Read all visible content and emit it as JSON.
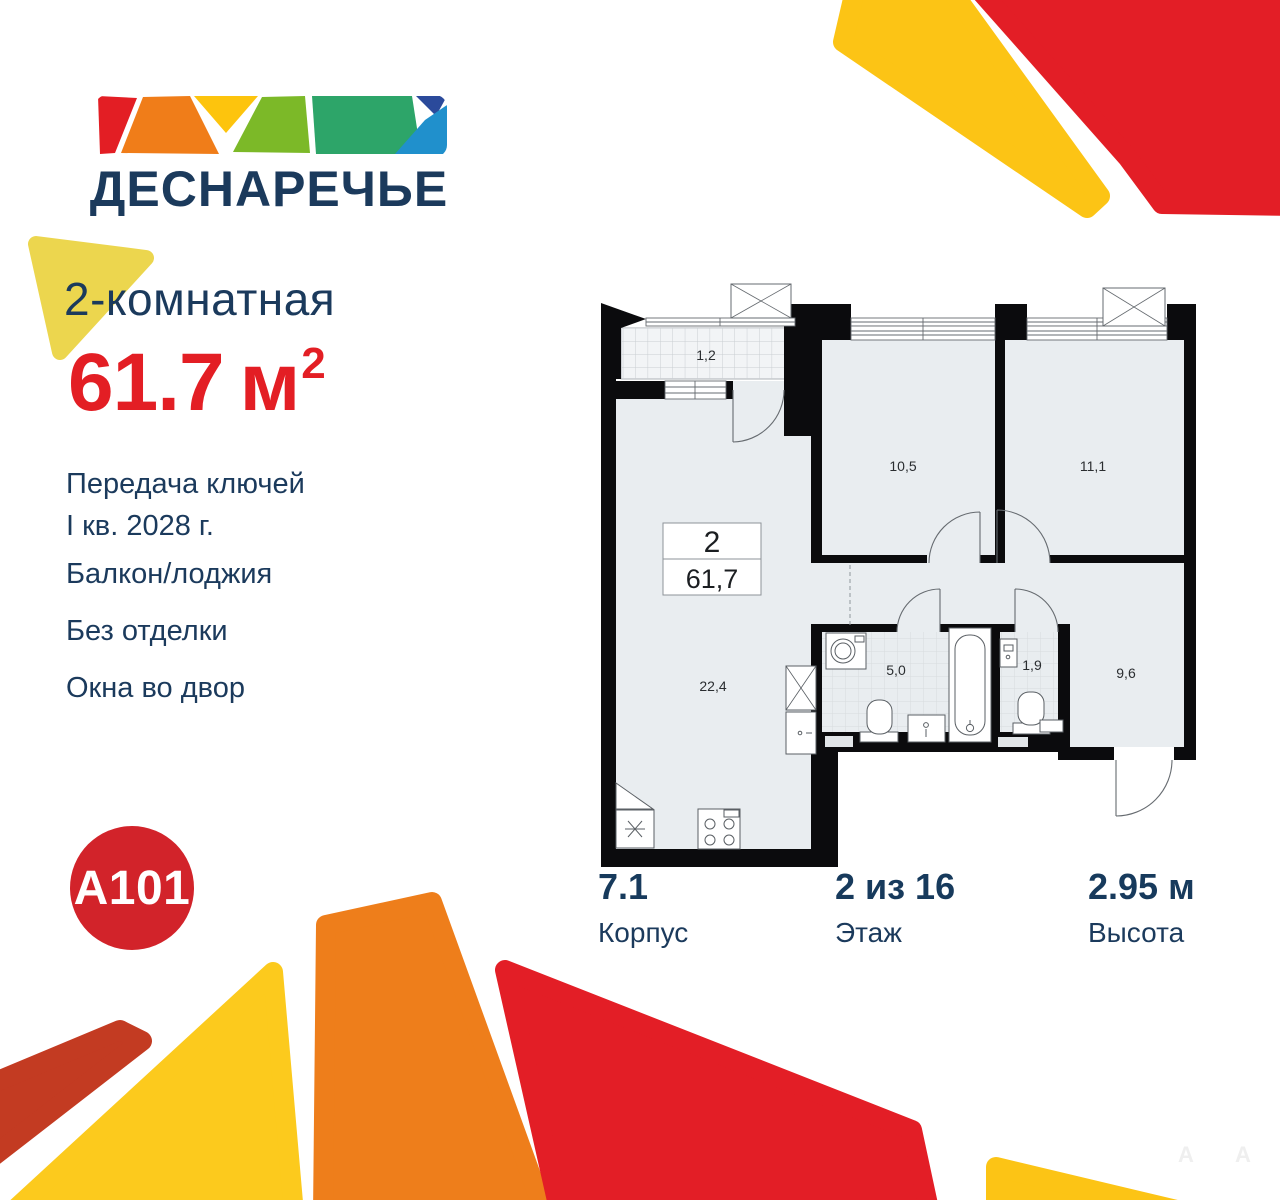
{
  "logo": {
    "title": "ДЕСНАРЕЧЬЕ"
  },
  "listing": {
    "type_label": "2-комнатная",
    "area_number": "61.7",
    "area_unit": "м",
    "area_sup": "2",
    "features": [
      {
        "text": "Передача ключей"
      },
      {
        "text": "I кв. 2028 г."
      },
      {
        "text": "Балкон/лоджия"
      },
      {
        "text": "Без отделки"
      },
      {
        "text": "Окна во двор"
      }
    ]
  },
  "plan": {
    "unit_rooms": "2",
    "unit_area": "61,7",
    "rooms": {
      "balcony": "1,2",
      "bedroom1": "10,5",
      "bedroom2": "11,1",
      "living": "22,4",
      "bathroom": "5,0",
      "wc": "1,9",
      "hallway": "9,6"
    }
  },
  "stats": [
    {
      "value": "7.1",
      "label": "Корпус"
    },
    {
      "value": "2 из 16",
      "label": "Этаж"
    },
    {
      "value": "2.95 м",
      "label": "Высота"
    }
  ],
  "brand": {
    "badge": "A101"
  },
  "watermark": {
    "text": "A"
  },
  "colors": {
    "navy": "#1B3A5C",
    "red": "#E31E24",
    "brand_red": "#D2232A",
    "gold": "#FCC415",
    "soft_yellow": "#ECD64E",
    "orange": "#EE7E1B",
    "brick": "#C33B22",
    "lime": "#7CB928",
    "teal": "#2DA569",
    "blue_dark": "#2B4A9B",
    "blue_light": "#2090CC",
    "plan_wall": "#0B0B0D",
    "plan_floor": "#E9EDF0"
  }
}
